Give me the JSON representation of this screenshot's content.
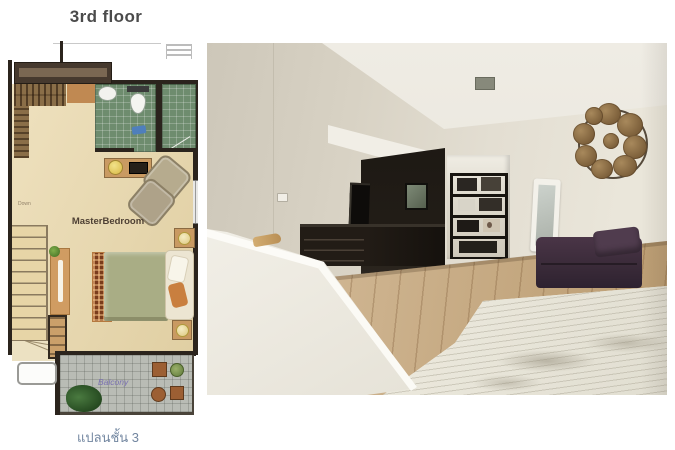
{
  "page": {
    "background": "#ffffff"
  },
  "floor_plan": {
    "title": "3rd floor",
    "caption": "แปลนชั้น 3",
    "labels": {
      "master_bedroom": "MasterBedroom",
      "balcony": "Balcony",
      "stairs_direction": "Down"
    },
    "rooms": [
      "MasterBedroom",
      "Bathroom",
      "Shower room",
      "Balcony",
      "Staircase"
    ],
    "features": [
      "wardrobe",
      "closet",
      "sink",
      "toilet",
      "bath-mat",
      "tv-console",
      "lamp",
      "armchair",
      "staircase-down",
      "desk",
      "drawer-cabinet",
      "rug",
      "double-bed",
      "pillows",
      "nightstand",
      "balcony-table-set",
      "potted-plant",
      "planter-box"
    ],
    "colors": {
      "title_text": "#4b4b4b",
      "caption_text": "#7286a0",
      "balcony_label_text": "#7b72b0",
      "wall": "#2b241d",
      "bedroom_floor": "#e9d7a9",
      "bathroom_tile": "#6e8c6e",
      "balcony_tile": "#b9bcb5",
      "wood_furniture": "#c99a62",
      "bed_blanket": "#a9ad85",
      "rug": "#7a3c1c"
    }
  },
  "photo": {
    "scene": "master bedroom interior with wood floor",
    "elements": [
      "ceiling-vent",
      "dark-hallway",
      "leaning-dark-mirror",
      "alcove-bookshelf",
      "standing-mirror",
      "round-wicker-wall-art",
      "purple-sofa",
      "white-bed",
      "dark-dresser",
      "white-stair-banister",
      "wood-handle",
      "wall-outlet",
      "laminate-floor"
    ],
    "colors": {
      "wall": "#e3ded2",
      "ceiling": "#efece4",
      "hallway": "#181410",
      "floor_wood": "#c9a87a",
      "sofa": "#3f2e3d",
      "bed": "#efece1"
    }
  }
}
